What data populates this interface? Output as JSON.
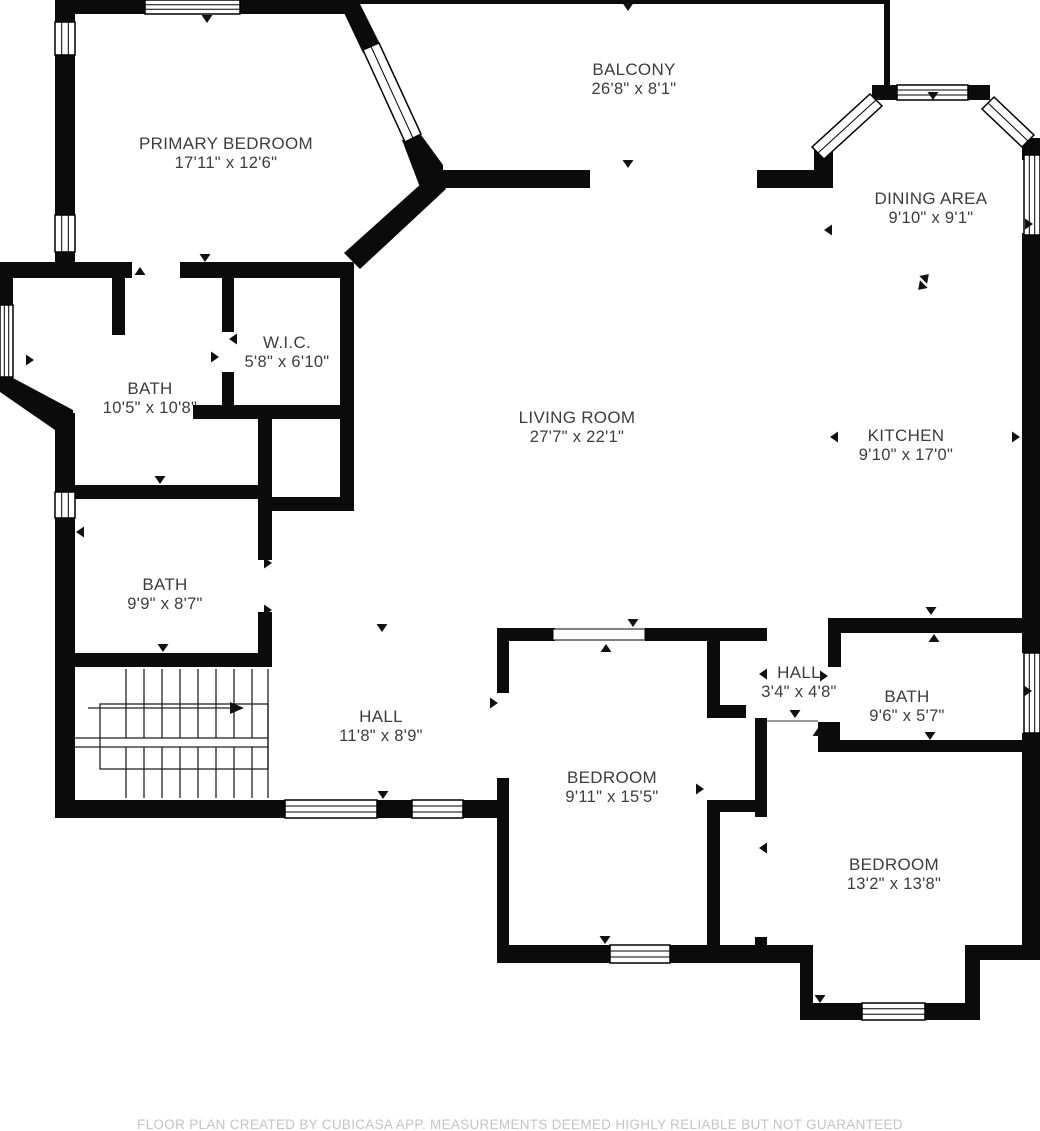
{
  "plan": {
    "rooms": [
      {
        "name": "PRIMARY BEDROOM",
        "dims": "17'11\" x 12'6\""
      },
      {
        "name": "BALCONY",
        "dims": "26'8\" x 8'1\""
      },
      {
        "name": "DINING AREA",
        "dims": "9'10\" x 9'1\""
      },
      {
        "name": "W.I.C.",
        "dims": "5'8\" x 6'10\""
      },
      {
        "name": "BATH",
        "dims": "10'5\" x 10'8\""
      },
      {
        "name": "LIVING ROOM",
        "dims": "27'7\" x 22'1\""
      },
      {
        "name": "KITCHEN",
        "dims": "9'10\" x 17'0\""
      },
      {
        "name": "BATH",
        "dims": "9'9\" x 8'7\""
      },
      {
        "name": "HALL",
        "dims": "11'8\" x 8'9\""
      },
      {
        "name": "BEDROOM",
        "dims": "9'11\" x 15'5\""
      },
      {
        "name": "HALL",
        "dims": "3'4\" x 4'8\""
      },
      {
        "name": "BATH",
        "dims": "9'6\" x 5'7\""
      },
      {
        "name": "BEDROOM",
        "dims": "13'2\" x 13'8\""
      }
    ],
    "disclaimer": "FLOOR PLAN CREATED BY CUBICASA APP. MEASUREMENTS DEEMED HIGHLY RELIABLE BUT NOT GUARANTEED",
    "colors": {
      "wall": "#0b0b0b",
      "background": "#ffffff",
      "label_text": "#3d3d3d",
      "disclaimer_text": "#c4c4c4"
    }
  }
}
